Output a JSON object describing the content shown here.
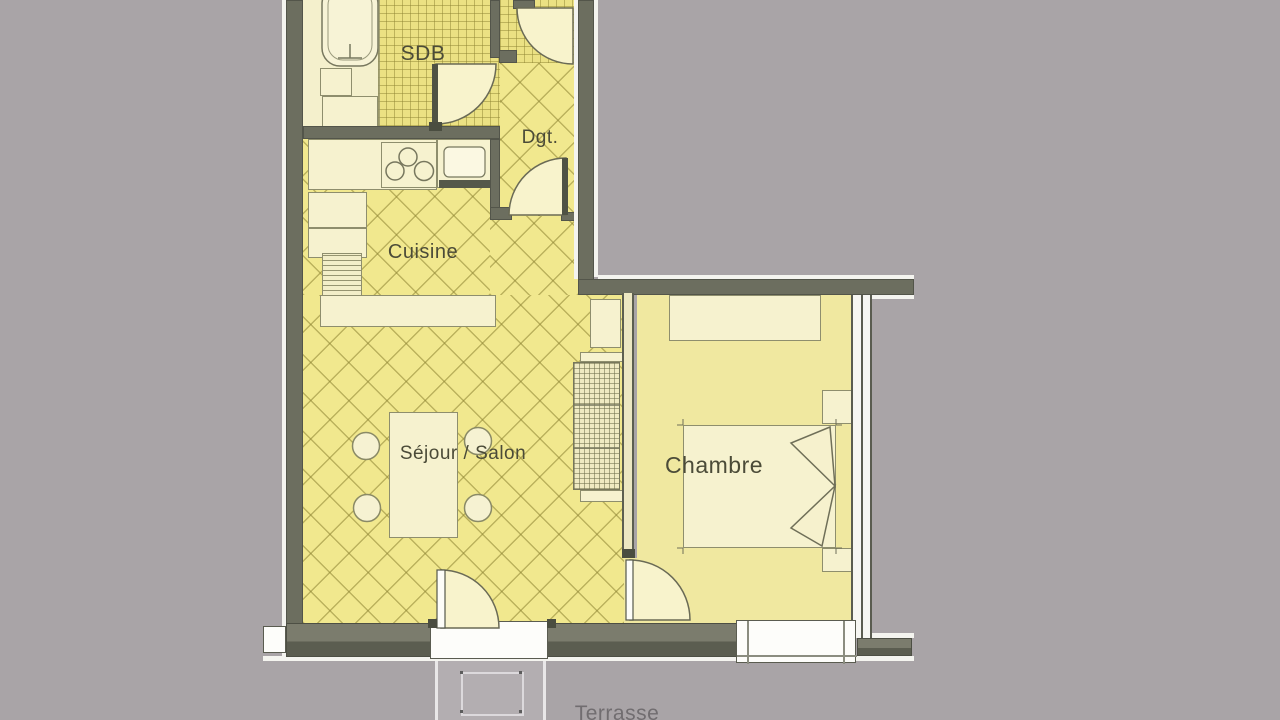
{
  "plan": {
    "type": "apartment-floor-plan",
    "rooms": {
      "sdb": {
        "label": "SDB"
      },
      "dgt": {
        "label": "Dgt."
      },
      "cuisine": {
        "label": "Cuisine"
      },
      "sejour": {
        "label": "Séjour / Salon"
      },
      "chambre": {
        "label": "Chambre"
      },
      "terrasse": {
        "label": "Terrasse"
      }
    },
    "fixtures": [
      "bathtub",
      "washbasin-cabinet",
      "stove-burners",
      "kitchen-sink",
      "kitchen-cabinets",
      "radiator",
      "bar-counter",
      "dining-table",
      "chairs",
      "shelving-unit",
      "wardrobe",
      "double-bed",
      "duvet-fold",
      "nightstand",
      "terrace-table",
      "entrance-door",
      "interior-door",
      "window",
      "french-window"
    ],
    "colors": {
      "background": "#a9a4a7",
      "wall": "#6c6e5f",
      "tile_floor": "#f1e88e",
      "plain_floor": "#f0e8a0",
      "furniture": "#f6f2cf",
      "outline_white": "#f4f4ef",
      "label_text": "#4b4b38",
      "terrace": "#b3aeb1"
    }
  }
}
